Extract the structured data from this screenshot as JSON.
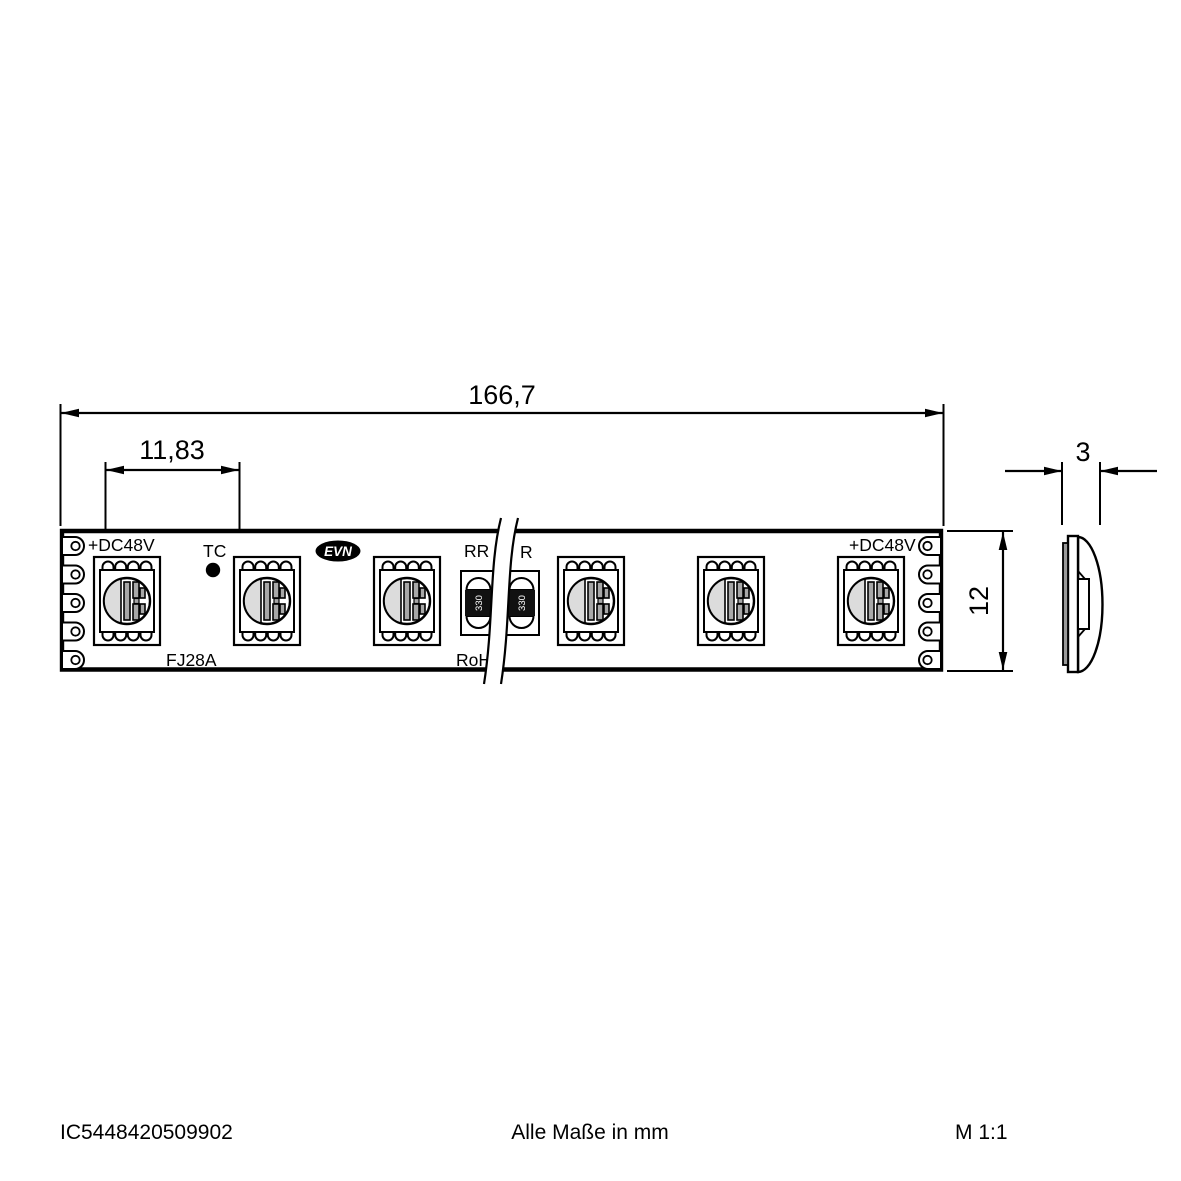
{
  "drawing": {
    "dimensions": {
      "overall_length": "166,7",
      "led_pitch": "11,83",
      "thickness": "3",
      "height": "12"
    },
    "strip": {
      "label_dc48v_left": "+DC48V",
      "label_tc": "TC",
      "label_type": "FJ28A",
      "label_rr": "RR",
      "label_rohs": "RoH",
      "label_r_right": "R",
      "label_dc48v_right": "+DC48V",
      "logo": "EVN",
      "resistor_value": "330"
    },
    "colors": {
      "line": "#000000",
      "lens_shade": "#dcdcdc",
      "die_bar": "#a8a8a8",
      "pcb_edge": "#9a9a9a",
      "resistor_body": "#111111"
    }
  },
  "footer": {
    "article_number": "IC5448420509902",
    "units_note": "Alle Maße in mm",
    "scale": "M 1:1"
  }
}
